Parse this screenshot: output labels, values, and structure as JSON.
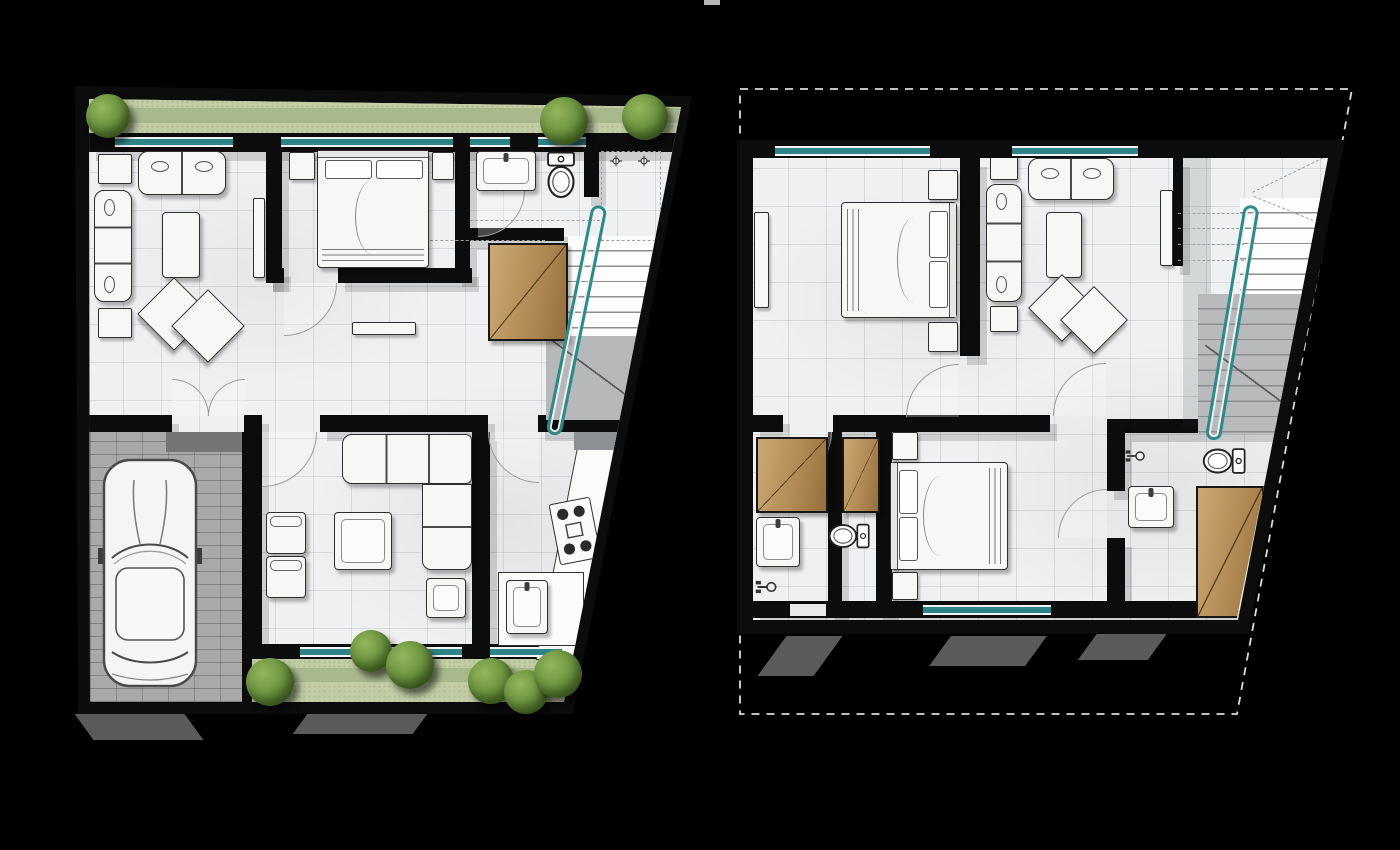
{
  "scene": {
    "type": "architectural floor plans, rendered top-down view on black background",
    "views": [
      "ground-floor-plan",
      "upper-floor-plan"
    ],
    "background": "#000000",
    "top_edge_smudge": true
  },
  "theme": {
    "wall": "#0c0c0c",
    "floor_tile": "#eef0f1",
    "tile_line": "#cfd3d8",
    "window_teal": "#2d8486",
    "rail_teal": "#2e8a88",
    "garden_light": "#c2cda4",
    "garden_dark": "#a9b98c",
    "bush_green": "#5d8434",
    "wood": "#b78f5b",
    "garage_paver": "#a9a9a9",
    "stair_gray": "#b9babc",
    "furniture_fill": "#f7f7f5",
    "furniture_line": "#2f2f2f",
    "door_arc": "#9d9d9d",
    "dashed_outline": "#e0e0e0",
    "drop_shadow": "#d7d7d7"
  },
  "ground_floor": {
    "outline": "trapezoid with slanted right wall",
    "front_yard": {
      "position": "top strip",
      "shrubs": 3
    },
    "back_yard": {
      "position": "bottom strip",
      "shrubs": 6
    },
    "rooms": [
      {
        "name": "living-room",
        "furniture": [
          "two-seat-sofa",
          "three-seat-sofa",
          "side-table",
          "side-table",
          "coffee-table",
          "double-diamond-rug",
          "wall-console"
        ]
      },
      {
        "name": "master-bedroom",
        "furniture": [
          "double-bed",
          "nightstand",
          "nightstand"
        ]
      },
      {
        "name": "bathroom",
        "furniture": [
          "vanity-sink",
          "toilet",
          "dashed-shower-enclosure",
          "shower-mixer",
          "shower-mixer"
        ]
      },
      {
        "name": "hallway",
        "furniture": [
          "hall-console",
          "built-in-wardrobe",
          "french-double-doors"
        ]
      },
      {
        "name": "staircase",
        "furniture": [
          "teal-handrail",
          "upper-flight",
          "landing"
        ]
      },
      {
        "name": "garage",
        "furniture": [
          "car"
        ]
      },
      {
        "name": "family-room",
        "furniture": [
          "sectional-sofa",
          "armchair",
          "armchair",
          "coffee-table",
          "ottoman"
        ]
      },
      {
        "name": "kitchen",
        "furniture": [
          "l-shaped-counter",
          "counter-return",
          "four-burner-cooktop",
          "kitchen-sink"
        ]
      }
    ],
    "windows": "teal-framed along front and back walls"
  },
  "upper_floor": {
    "outline": "dashed roof outline surrounding solid floor slab",
    "rooms": [
      {
        "name": "master-bedroom",
        "furniture": [
          "double-bed",
          "nightstand",
          "nightstand",
          "dresser"
        ]
      },
      {
        "name": "sitting-area",
        "furniture": [
          "two-seat-sofa",
          "three-seat-sofa",
          "side-table",
          "side-table",
          "coffee-table",
          "double-diamond-rug",
          "wall-console"
        ]
      },
      {
        "name": "staircase",
        "furniture": [
          "teal-handrail",
          "upper-flight",
          "lower-flight",
          "headroom-dashed-lines"
        ]
      },
      {
        "name": "bathroom-1",
        "furniture": [
          "built-in-wardrobe",
          "vanity-sink",
          "shower-mixer"
        ]
      },
      {
        "name": "wc",
        "furniture": [
          "built-in-wardrobe",
          "toilet"
        ]
      },
      {
        "name": "bedroom-2",
        "furniture": [
          "double-bed",
          "nightstand",
          "nightstand"
        ]
      },
      {
        "name": "ensuite-bathroom",
        "furniture": [
          "toilet",
          "vanity-sink",
          "shower-mixer",
          "corner-wardrobe"
        ]
      }
    ],
    "windows": "teal-framed along top wall and bedroom-2 rear wall"
  }
}
